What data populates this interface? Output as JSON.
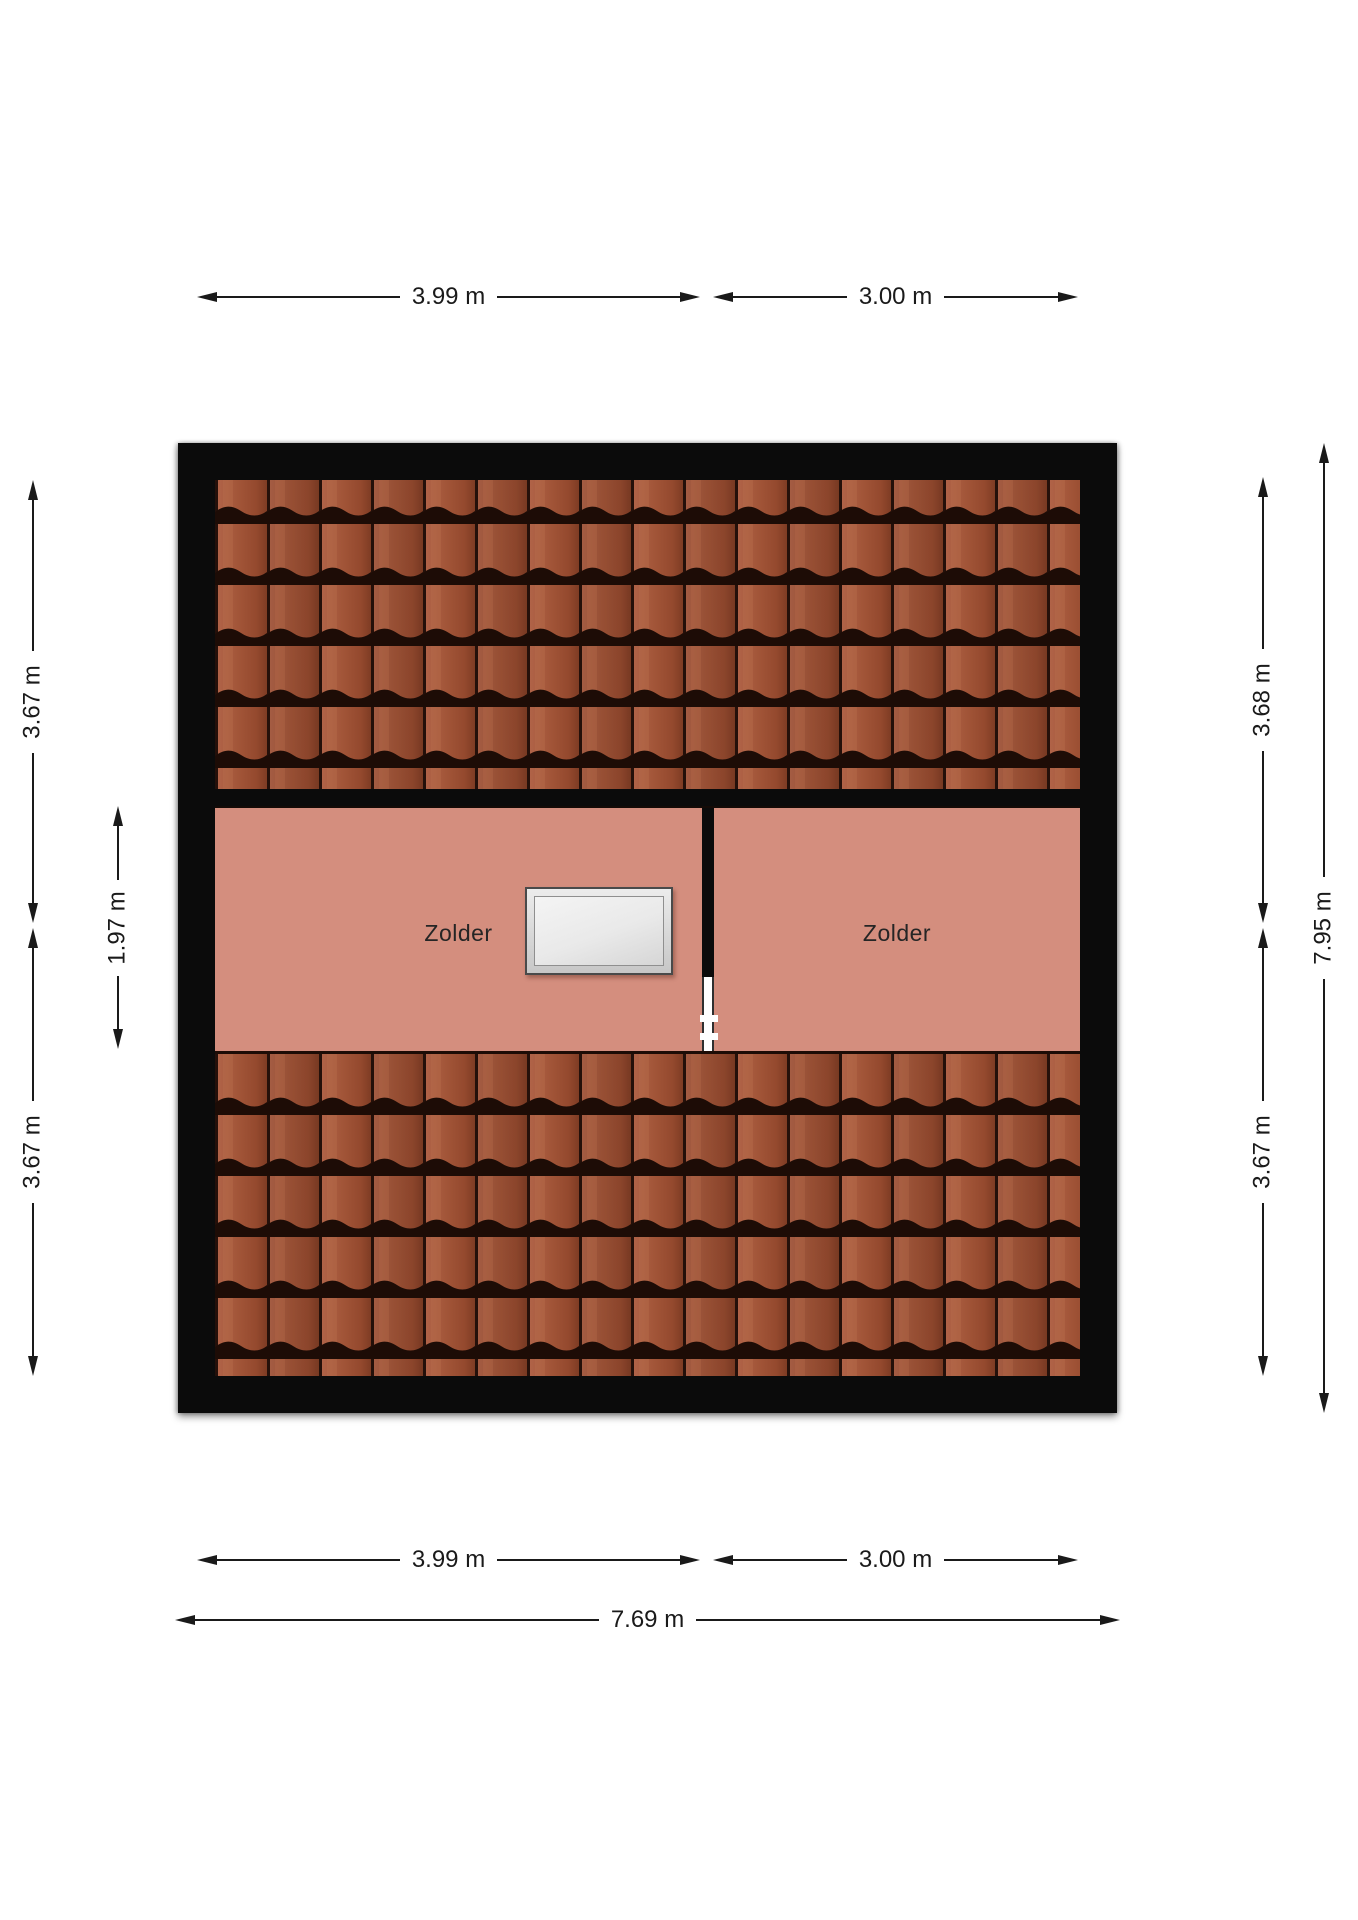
{
  "floorplan": {
    "rooms": {
      "left": {
        "label": "Zolder"
      },
      "right": {
        "label": "Zolder"
      }
    },
    "dimensions": {
      "top_left_width": {
        "label": "3.99 m"
      },
      "top_right_width": {
        "label": "3.00 m"
      },
      "bottom_left_width": {
        "label": "3.99 m"
      },
      "bottom_right_width": {
        "label": "3.00 m"
      },
      "bottom_total_width": {
        "label": "7.69 m"
      },
      "left_upper_depth": {
        "label": "3.67 m"
      },
      "left_attic_depth": {
        "label": "1.97 m"
      },
      "left_lower_depth": {
        "label": "3.67 m"
      },
      "right_upper_depth": {
        "label": "3.68 m"
      },
      "right_total_depth": {
        "label": "7.95 m"
      },
      "right_lower_depth": {
        "label": "3.67 m"
      }
    },
    "colors": {
      "background": "#ffffff",
      "wall": "#0b0b0b",
      "attic_floor": "#d48e7e",
      "roof_tile": "#a25538",
      "roof_tile_shadow": "#1d0c06",
      "dimension_line": "#1a1a1a",
      "skylight_frame": "#d9d9d9",
      "skylight_pane": "#e9e9e9"
    }
  }
}
